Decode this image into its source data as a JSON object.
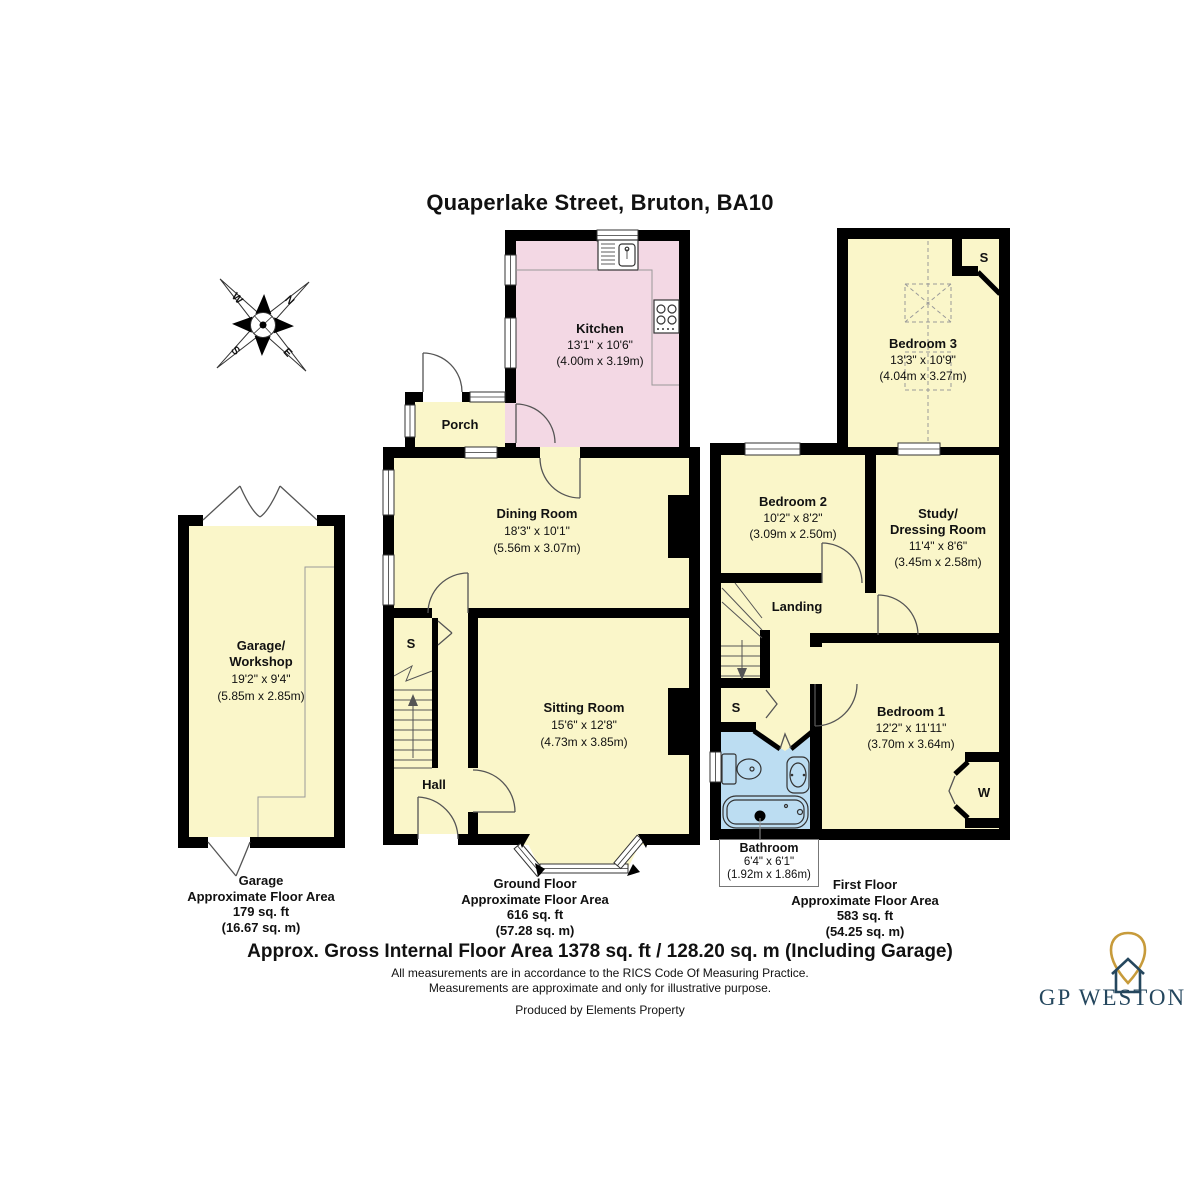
{
  "title": "Quaperlake Street, Bruton, BA10",
  "compass": {
    "n": "N",
    "e": "E",
    "s": "S",
    "w": "W"
  },
  "closets": {
    "s": "S",
    "w": "W"
  },
  "rooms": {
    "garage": {
      "name1": "Garage/",
      "name2": "Workshop",
      "imperial": "19'2\" x 9'4\"",
      "metric": "(5.85m x 2.85m)"
    },
    "kitchen": {
      "name": "Kitchen",
      "imperial": "13'1\" x 10'6\"",
      "metric": "(4.00m x 3.19m)"
    },
    "porch": {
      "name": "Porch"
    },
    "dining": {
      "name": "Dining Room",
      "imperial": "18'3\" x 10'1\"",
      "metric": "(5.56m x 3.07m)"
    },
    "sitting": {
      "name": "Sitting Room",
      "imperial": "15'6\" x 12'8\"",
      "metric": "(4.73m x 3.85m)"
    },
    "hall": {
      "name": "Hall"
    },
    "bedroom3": {
      "name": "Bedroom 3",
      "imperial": "13'3\" x 10'9\"",
      "metric": "(4.04m x 3.27m)"
    },
    "bedroom2": {
      "name": "Bedroom 2",
      "imperial": "10'2\" x 8'2\"",
      "metric": "(3.09m x 2.50m)"
    },
    "study": {
      "name1": "Study/",
      "name2": "Dressing Room",
      "imperial": "11'4\" x 8'6\"",
      "metric": "(3.45m x 2.58m)"
    },
    "landing": {
      "name": "Landing"
    },
    "bedroom1": {
      "name": "Bedroom 1",
      "imperial": "12'2\" x 11'11\"",
      "metric": "(3.70m x 3.64m)"
    },
    "bathroom": {
      "name": "Bathroom",
      "imperial": "6'4\" x 6'1\"",
      "metric": "(1.92m x 1.86m)"
    }
  },
  "areas": {
    "garage": {
      "line1": "Garage",
      "line2": "Approximate Floor Area",
      "line3": "179 sq. ft",
      "line4": "(16.67 sq. m)"
    },
    "ground": {
      "line1": "Ground Floor",
      "line2": "Approximate Floor Area",
      "line3": "616 sq. ft",
      "line4": "(57.28 sq. m)"
    },
    "first": {
      "line1": "First Floor",
      "line2": "Approximate Floor Area",
      "line3": "583 sq. ft",
      "line4": "(54.25 sq. m)"
    }
  },
  "footer": {
    "gross": "Approx. Gross Internal Floor Area 1378 sq. ft / 128.20 sq. m (Including Garage)",
    "rics": "All measurements are in accordance to the RICS Code Of Measuring Practice.",
    "approx": "Measurements are approximate and only for illustrative purpose.",
    "produced": "Produced by Elements Property"
  },
  "brand": {
    "name": "GP WESTON"
  },
  "colors": {
    "room_yellow": "#FAF6C9",
    "kitchen_pink": "#F3D8E4",
    "bathroom_blue": "#BCDDF2",
    "wall_black": "#000000",
    "brand_navy": "#25475E",
    "brand_gold": "#C79B3B"
  }
}
